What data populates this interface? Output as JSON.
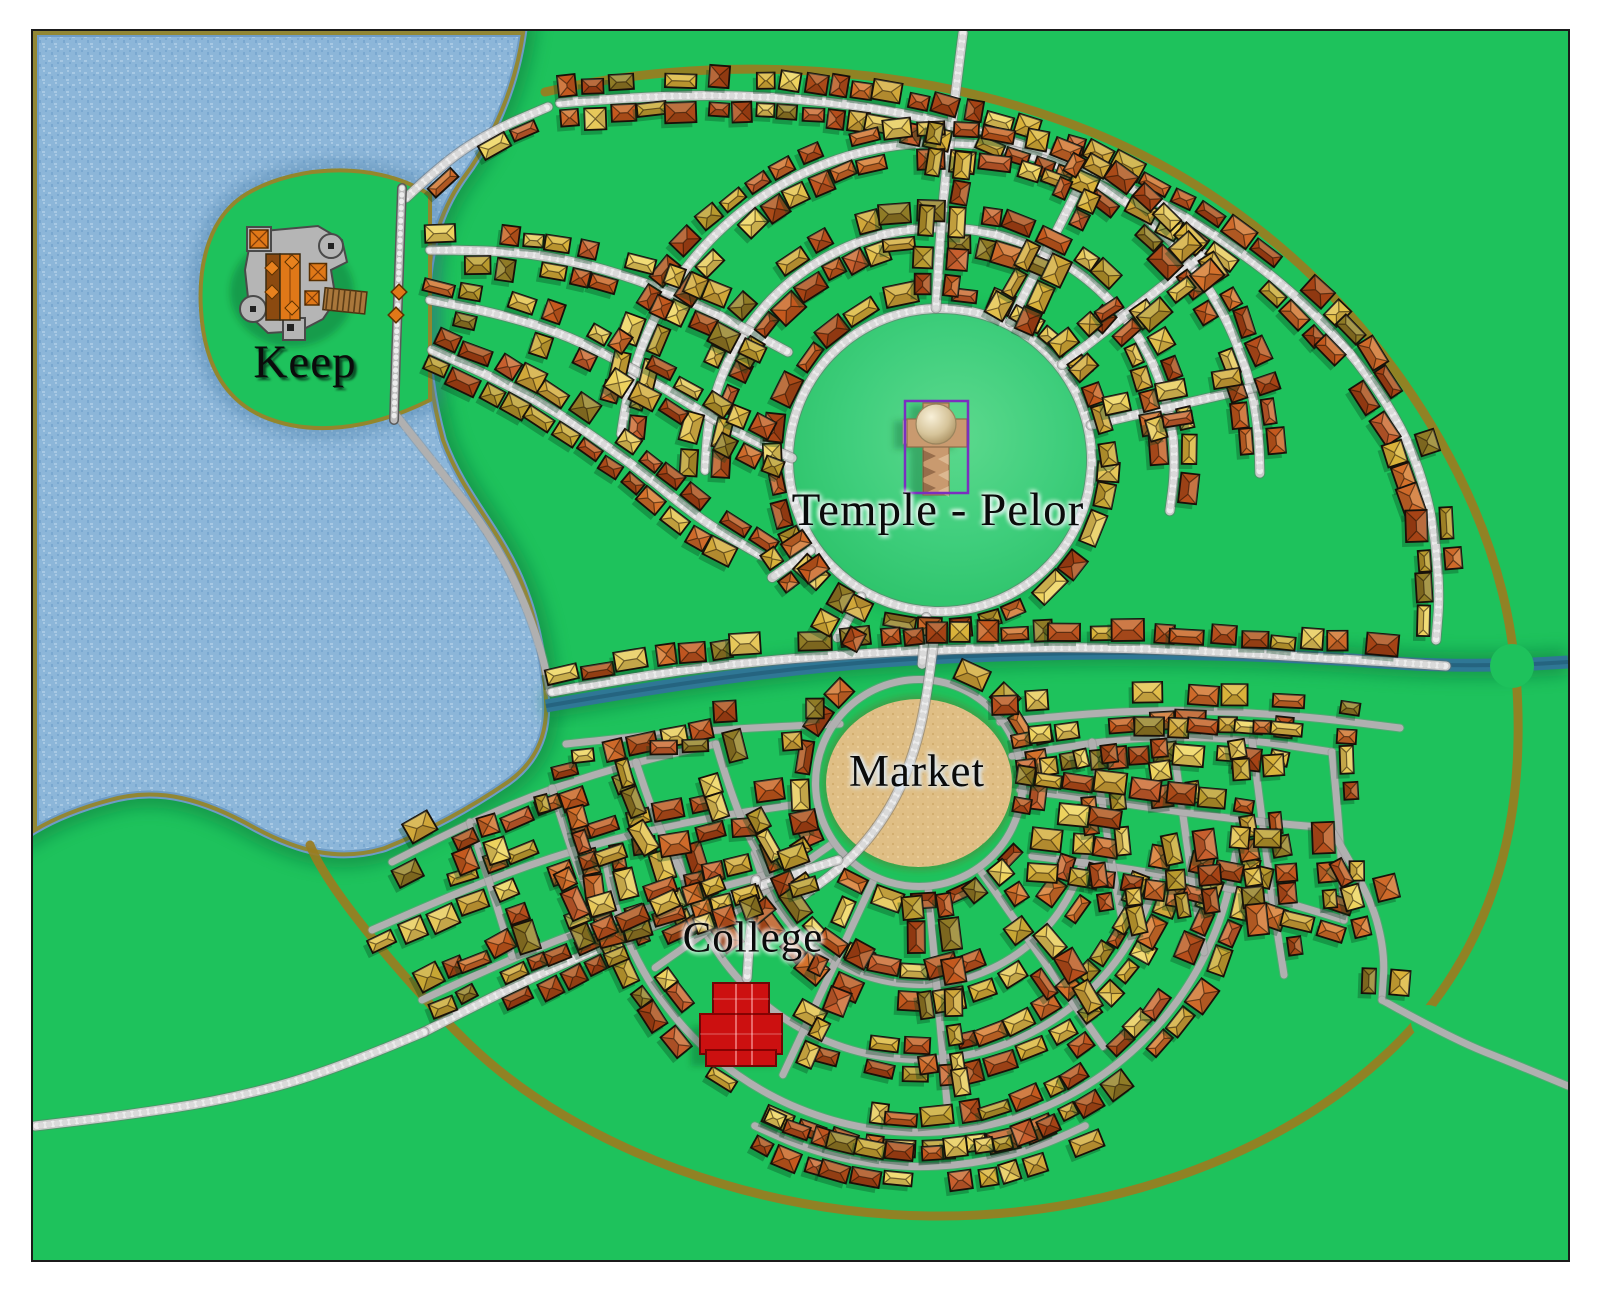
{
  "map_type": "fantasy-town-map",
  "landmarks": [
    {
      "id": "keep",
      "label": "Keep"
    },
    {
      "id": "temple",
      "label": "Temple - Pelor"
    },
    {
      "id": "market",
      "label": "Market"
    },
    {
      "id": "college",
      "label": "College"
    }
  ],
  "colors": {
    "grass": "#1EC25C",
    "plaza_center": "#5CD98D",
    "plaza_mid": "#3FCE7C",
    "plaza_edge": "#2BC268",
    "lake": "#8CB6D9",
    "lake_speckle_light": "#A8C9E4",
    "lake_speckle_dark": "#7AA8D0",
    "shore_olive": "#93862C",
    "shore_shadow": "#0A7A3C",
    "water_edge": "#6E9CC6",
    "river": "#2F7795",
    "river_core": "#235F7B",
    "sand": "#DFBE85",
    "sand_dark": "#D2AE6F",
    "sand_light": "#EACD9A",
    "cobble_base": "#C9C9C9",
    "cobble_stone": "#ECECEC",
    "cobble_edge": "#6E6E6E",
    "road_smooth": "#B0B0B0",
    "road_smooth_edge": "#8F8F8F",
    "town_ring": "#9A7D1F",
    "roof_palette": [
      "#C4591E",
      "#D4712B",
      "#B54E1C",
      "#A64315",
      "#CE6A2A",
      "#C75F2E",
      "#BF5520",
      "#AA4A18",
      "#E2BF4B",
      "#D9B23A",
      "#C7A634",
      "#EDD25E",
      "#B89A2E",
      "#8F7B26",
      "#E6C85A",
      "#D0A73A"
    ],
    "roof_outline": "#17110A",
    "college_red": "#CC1010",
    "college_dark": "#6E0606",
    "college_seam": "#F08080",
    "temple_tan": "#C99A6F",
    "temple_shade": "#8F6B49",
    "temple_dome_hi": "#F8F0D8",
    "temple_dome_lo": "#A98F60",
    "temple_outline": "#7B2FBF",
    "keep_stone": "#B5B5B5",
    "keep_stone_edge": "#4A4A4A",
    "keep_roof": "#E07818",
    "keep_brown": "#8B4A10",
    "annex_wood": "#A9773B",
    "annex_stripe": "#5E3E17",
    "wall_gray": "#BDBDBD",
    "label_ink": "#0B0B0B"
  }
}
